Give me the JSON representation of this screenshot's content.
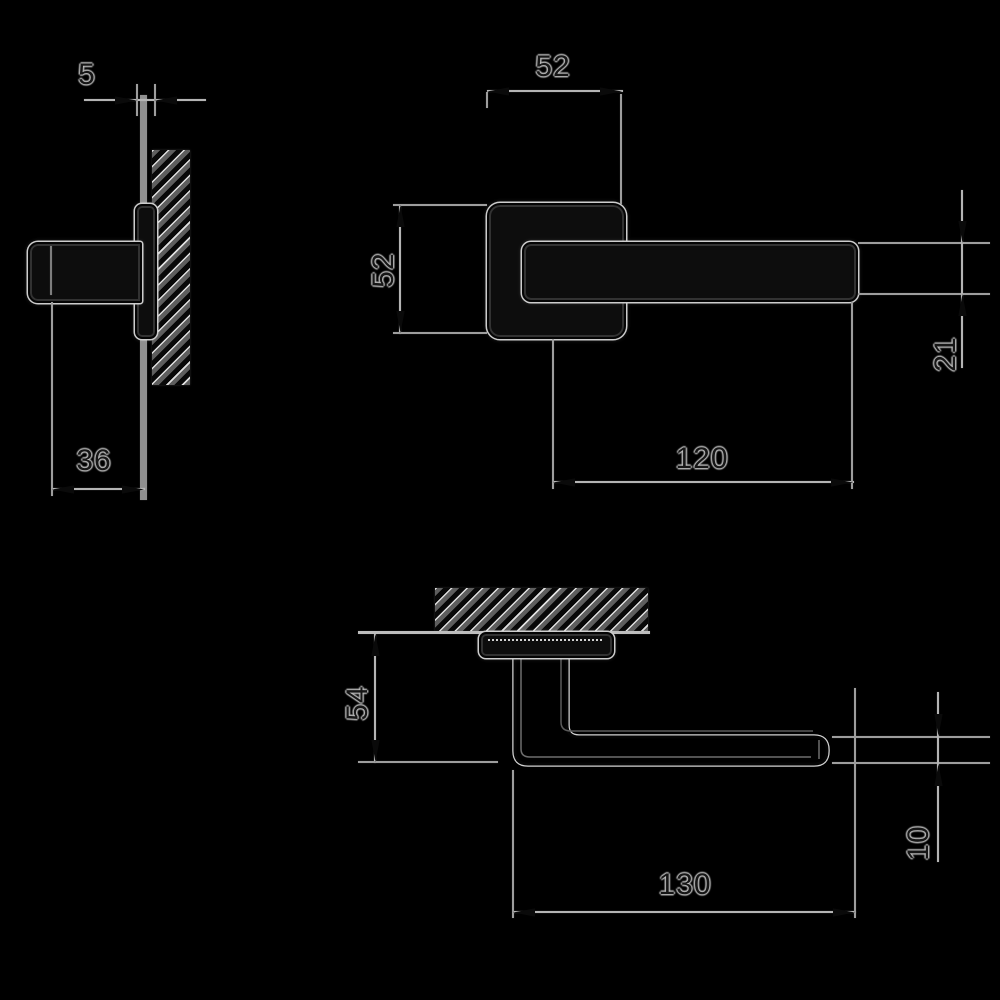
{
  "drawing": {
    "type": "technical-dimension-drawing",
    "subject": "lever door handle on slim square rose - three orthographic views",
    "background_color": "#000000",
    "line_color": "#b4b4b4",
    "views": {
      "plan": {
        "description": "handle seen from above mounted on door panel (hatched section)",
        "dims": {
          "rose_thickness": "5",
          "grip_clearance": "36"
        }
      },
      "front": {
        "description": "front face view: square rose with horizontal lever",
        "dims": {
          "rose_width": "52",
          "rose_height": "52",
          "lever_length": "120",
          "grip_width": "21"
        }
      },
      "section": {
        "description": "side section through door (hatched) showing projection",
        "dims": {
          "projection": "54",
          "grip_thickness": "10",
          "overall_length": "130"
        }
      }
    }
  }
}
